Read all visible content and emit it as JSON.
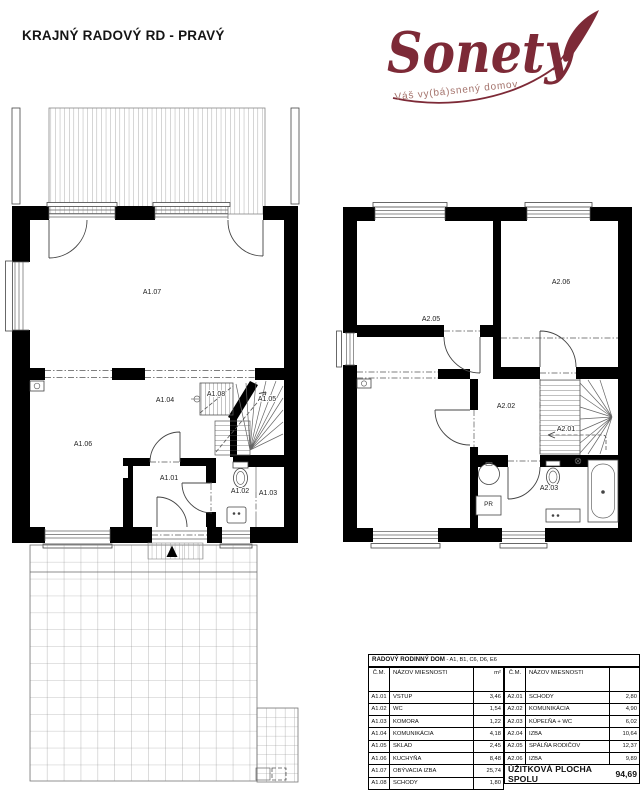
{
  "page": {
    "title": "KRAJNÝ RADOVÝ RD - PRAVÝ"
  },
  "logo": {
    "text": "Sonety",
    "tagline": "Váš vy(bá)snený domov",
    "brand_color": "#7d2a37",
    "tagline_color": "#a4736c"
  },
  "plan_ground": {
    "labels": {
      "a101": "A1.01",
      "a102": "A1.02",
      "a103": "A1.03",
      "a104": "A1.04",
      "a105": "A1.05",
      "a106": "A1.06",
      "a107": "A1.07",
      "a108": "A1.08"
    }
  },
  "plan_upper": {
    "labels": {
      "a201": "A2.01",
      "a202": "A2.02",
      "a203": "A2.03",
      "a205": "A2.05",
      "a206": "A2.06",
      "pr": "PR"
    }
  },
  "table": {
    "title": "RADOVÝ RODINNÝ DOM",
    "title_suffix": " - A1, B1, C6, D6, E6",
    "headers": {
      "cm": "Č.M.",
      "name": "NÁZOV MIESNOSTI",
      "area": "m²",
      "area_right": ""
    },
    "ground": [
      {
        "cm": "A1.01",
        "name": "VSTUP",
        "area": "3,46"
      },
      {
        "cm": "A1.02",
        "name": "WC",
        "area": "1,54"
      },
      {
        "cm": "A1.03",
        "name": "KOMORA",
        "area": "1,22"
      },
      {
        "cm": "A1.04",
        "name": "KOMUNIKÁCIA",
        "area": "4,18"
      },
      {
        "cm": "A1.05",
        "name": "SKLAD",
        "area": "2,45"
      },
      {
        "cm": "A1.06",
        "name": "KUCHYŇA",
        "area": "8,48"
      },
      {
        "cm": "A1.07",
        "name": "OBÝVACIA IZBA",
        "area": "25,74"
      },
      {
        "cm": "A1.08",
        "name": "SCHODY",
        "area": "1,80"
      }
    ],
    "upper": [
      {
        "cm": "A2.01",
        "name": "SCHODY",
        "area": "2,80"
      },
      {
        "cm": "A2.02",
        "name": "KOMUNIKÁCIA",
        "area": "4,90"
      },
      {
        "cm": "A2.03",
        "name": "KÚPEĽŇA + WC",
        "area": "6,02"
      },
      {
        "cm": "A2.04",
        "name": "IZBA",
        "area": "10,64"
      },
      {
        "cm": "A2.05",
        "name": "SPÁLŇA RODIČOV",
        "area": "12,37"
      },
      {
        "cm": "A2.06",
        "name": "IZBA",
        "area": "9,89"
      }
    ],
    "total_label": "ÚŽITKOVÁ PLOCHA SPOLU",
    "total_value": "94,69"
  }
}
